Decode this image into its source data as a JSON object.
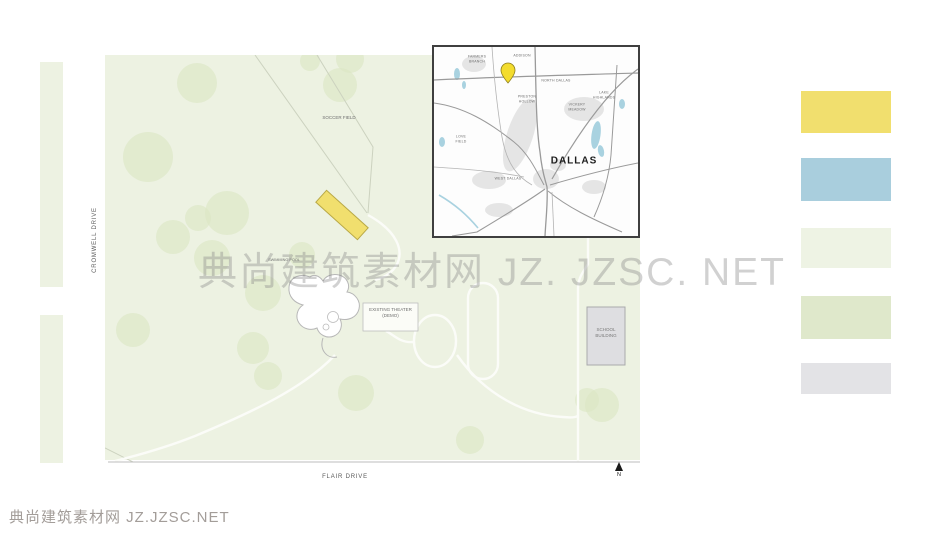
{
  "watermark": {
    "center_text": "典尚建筑素材网  JZ. JZSC. NET",
    "footer_text": "典尚建筑素材网 JZ.JZSC.NET"
  },
  "site_plan": {
    "labels": {
      "cromwell_drive": "CROMWELL DRIVE",
      "flair_drive": "FLAIR DRIVE",
      "soccer_field": "SOCCER FIELD",
      "swimming_pool": "SWIMMING POOL",
      "existing_theater": "EXISTING THEATER (DEMO)",
      "school_building": "SCHOOL BUILDING",
      "north": "N"
    },
    "colors": {
      "site_green": "#edf2e2",
      "tree_green": "#dbe6c5",
      "highlight_yellow": "#f1df6e",
      "highlight_border": "#b9a946",
      "building_gray": "#dedee1",
      "road_line": "#c9cfbc"
    },
    "trees": [
      [
        92,
        28,
        20
      ],
      [
        245,
        4,
        14
      ],
      [
        235,
        30,
        17
      ],
      [
        205,
        6,
        10
      ],
      [
        43,
        102,
        25
      ],
      [
        122,
        158,
        22
      ],
      [
        93,
        163,
        13
      ],
      [
        68,
        182,
        17
      ],
      [
        107,
        203,
        18
      ],
      [
        197,
        200,
        13
      ],
      [
        158,
        238,
        18
      ],
      [
        28,
        275,
        17
      ],
      [
        148,
        293,
        16
      ],
      [
        163,
        321,
        14
      ],
      [
        251,
        338,
        18
      ],
      [
        365,
        385,
        14
      ],
      [
        482,
        345,
        12
      ],
      [
        497,
        350,
        17
      ]
    ]
  },
  "map_inset": {
    "pin_color": "#f3dc2e",
    "water_color": "#a9d2e0",
    "area_labels": [
      {
        "text": "FARMERS\nBRANCH",
        "x": 43,
        "y": 12
      },
      {
        "text": "ADDISON",
        "x": 88,
        "y": 9
      },
      {
        "text": "NORTH DALLAS",
        "x": 122,
        "y": 34
      },
      {
        "text": "PRESTON\nHOLLOW",
        "x": 93,
        "y": 52
      },
      {
        "text": "VICKERY\nMEADOW",
        "x": 143,
        "y": 60
      },
      {
        "text": "LAKE\nHIGHLANDS",
        "x": 170,
        "y": 48
      },
      {
        "text": "LOVE\nFIELD",
        "x": 27,
        "y": 92
      },
      {
        "text": "WEST DALLAS",
        "x": 74,
        "y": 132
      },
      {
        "text": "DALLAS",
        "x": 140,
        "y": 114,
        "city": true
      }
    ]
  },
  "legend": {
    "swatches": [
      {
        "name": "proposed-building",
        "color": "#f1df6e"
      },
      {
        "name": "water",
        "color": "#a9cedd"
      },
      {
        "name": "open-lawn",
        "color": "#eef3e4"
      },
      {
        "name": "tree-canopy",
        "color": "#dfe8cb"
      },
      {
        "name": "existing-building",
        "color": "#e3e3e6"
      }
    ]
  }
}
